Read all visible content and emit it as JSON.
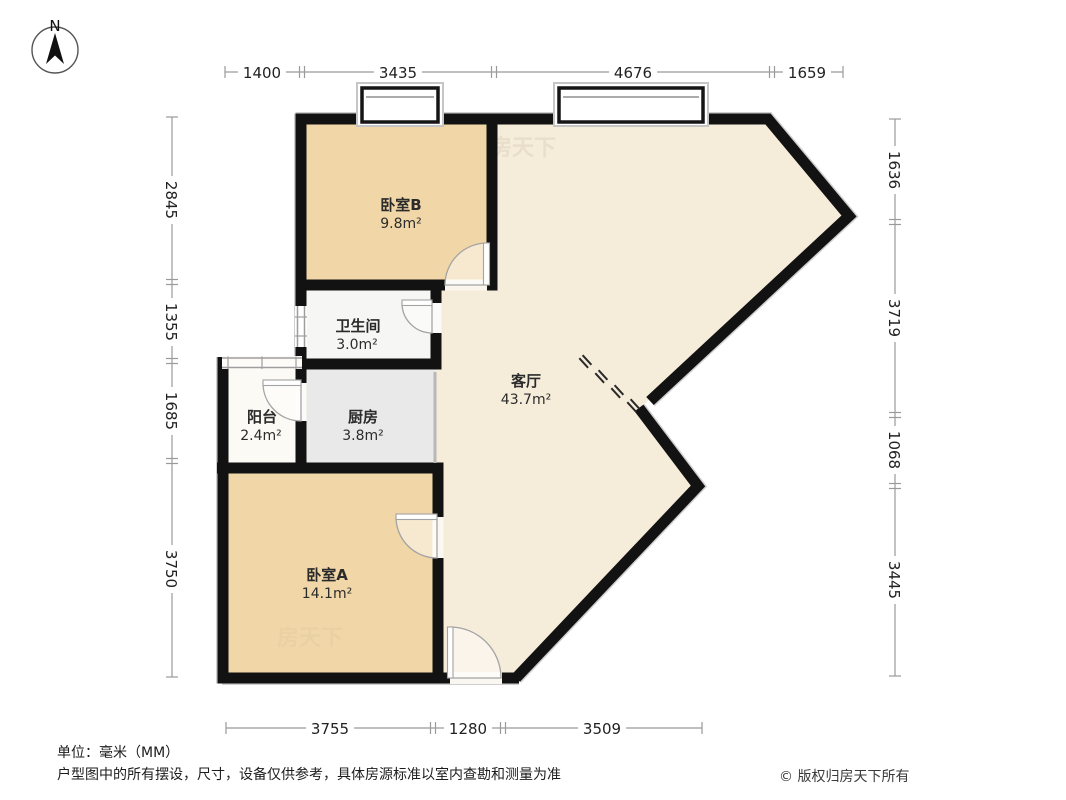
{
  "compass": {
    "label": "N"
  },
  "watermark": "房天下",
  "rooms": [
    {
      "name": "卧室B",
      "area": "9.8m²"
    },
    {
      "name": "卫生间",
      "area": "3.0m²"
    },
    {
      "name": "阳台",
      "area": "2.4m²"
    },
    {
      "name": "厨房",
      "area": "3.8m²"
    },
    {
      "name": "卧室A",
      "area": "14.1m²"
    },
    {
      "name": "客厅",
      "area": "43.7m²"
    }
  ],
  "dimensions": {
    "top": [
      "1400",
      "3435",
      "4676",
      "1659"
    ],
    "left": [
      "2845",
      "1355",
      "1685",
      "3750"
    ],
    "right": [
      "1636",
      "3719",
      "1068",
      "3445"
    ],
    "bottom": [
      "3755",
      "1280",
      "3509"
    ]
  },
  "footer": {
    "unit": "单位：毫米（MM）",
    "disclaimer": "户型图中的所有摆设，尺寸，设备仅供参考，具体房源标准以室内查勘和测量为准",
    "copyright": "© 版权归房天下所有"
  },
  "colors": {
    "wall": "#121212",
    "bedroom_fill": "#f1d7a8",
    "living_fill": "#f6ecda",
    "kitchen_fill": "#e9e9e9",
    "bathroom_fill": "#f6f6f4",
    "balcony_fill": "#fbfaf5",
    "dimension_line": "#9a9a9a",
    "text": "#222222"
  }
}
